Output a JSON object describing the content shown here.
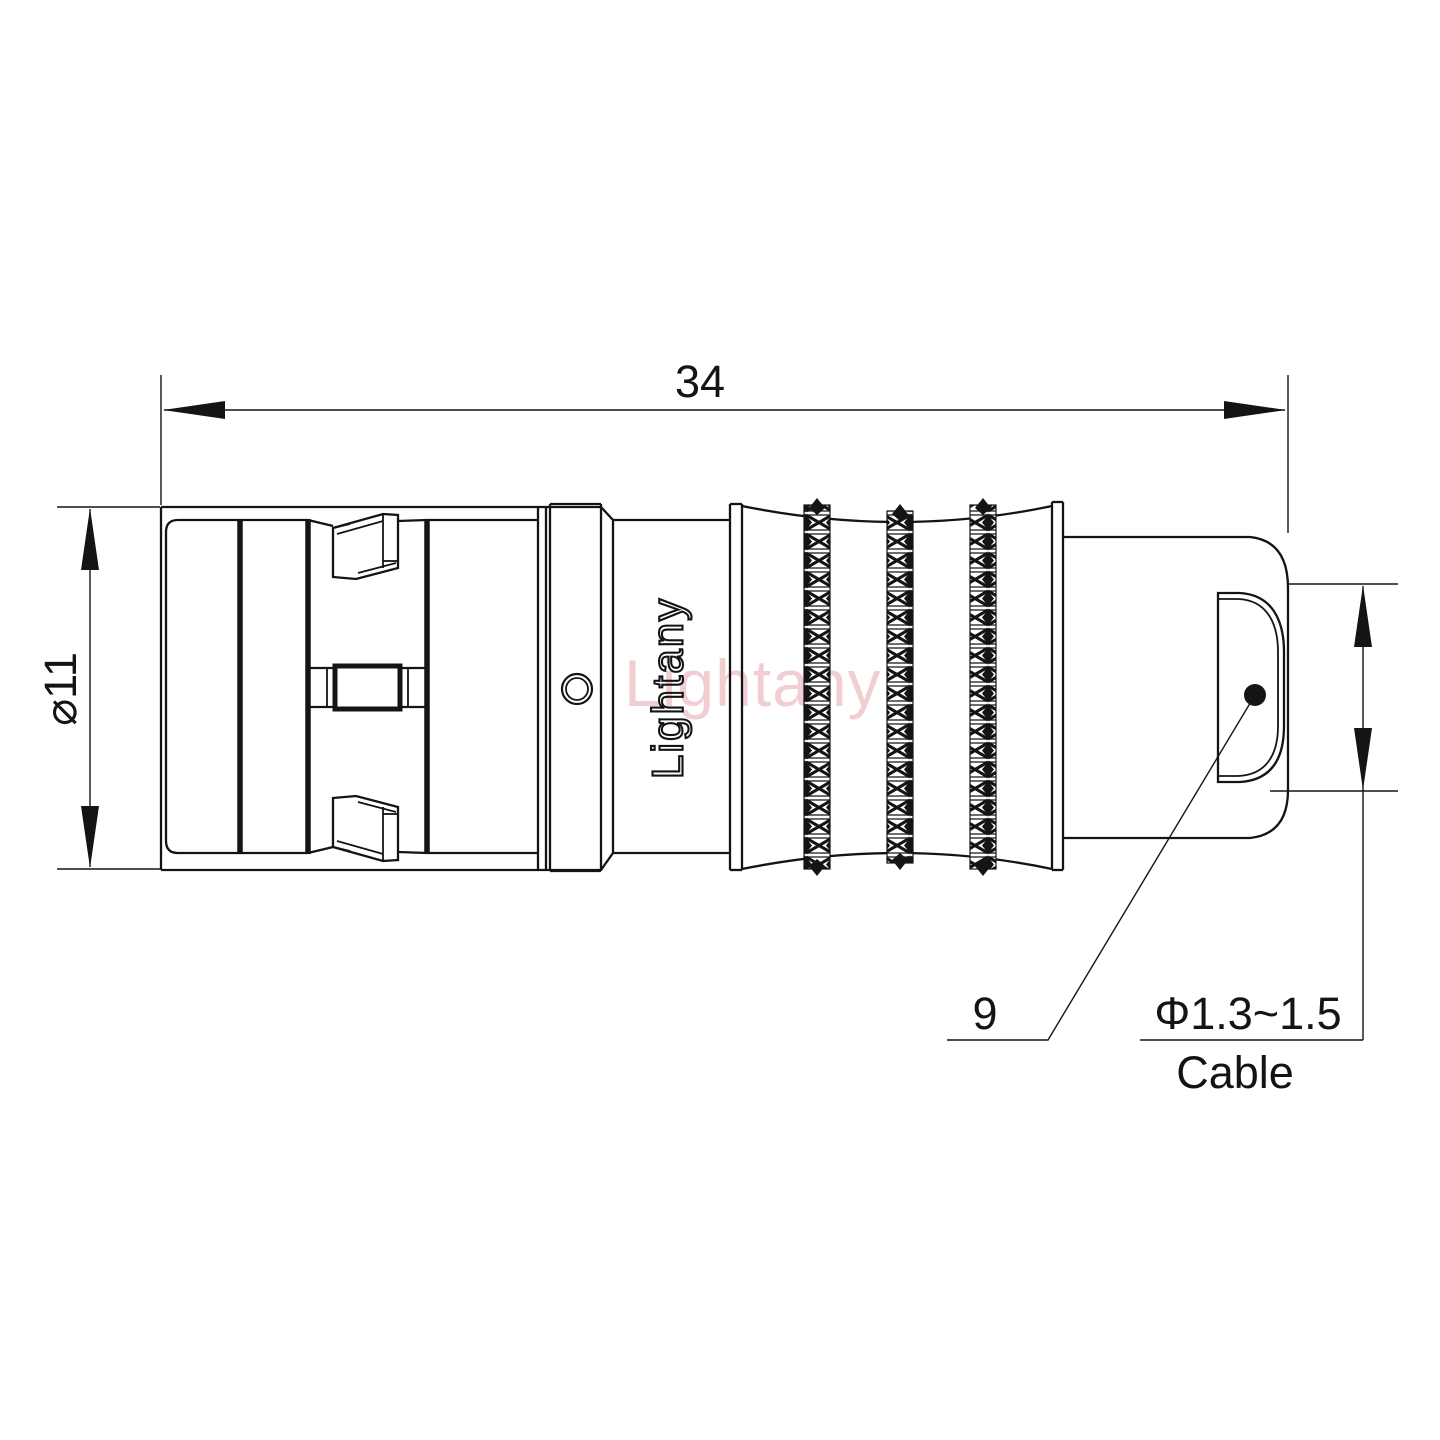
{
  "page": {
    "background_color": "#ffffff",
    "line_color": "#141414",
    "watermark_color": "#de8b95"
  },
  "drawing": {
    "watermark": "Lightany",
    "engraving": "Lightany",
    "dimensions": {
      "overall_length": "34",
      "body_diameter": "⌀11",
      "boot_ref": "9",
      "cable_range": "Φ1.3~1.5",
      "cable_word": "Cable"
    }
  }
}
